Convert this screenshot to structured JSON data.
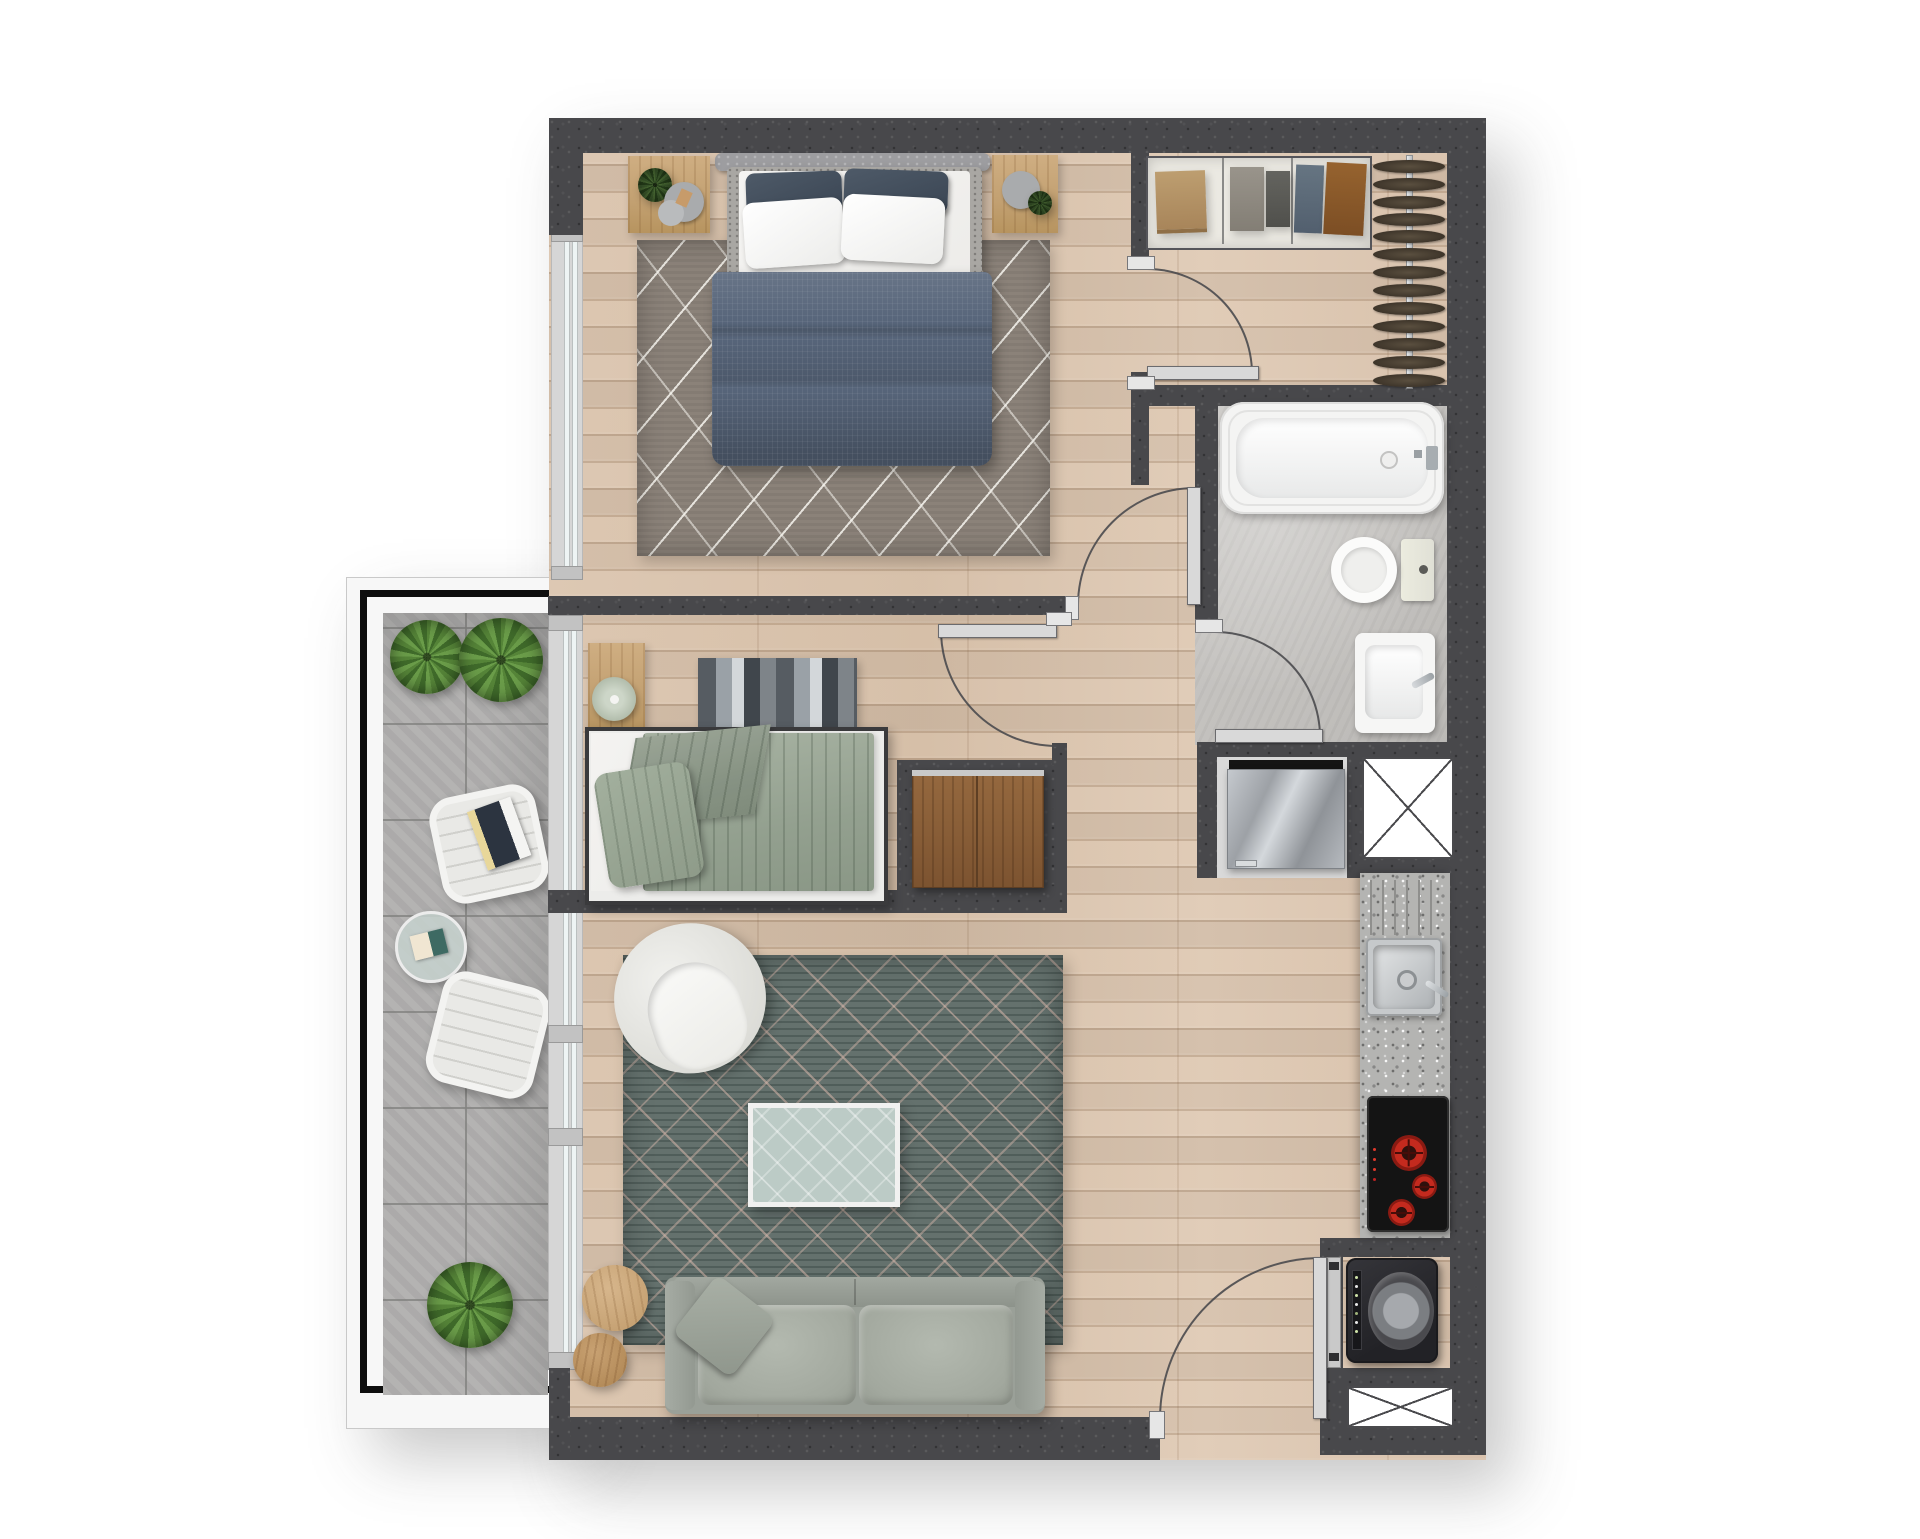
{
  "document": {
    "kind": "apartment floor plan",
    "view": "top-down 3D-rendered plan",
    "visible_text": "none"
  },
  "colors": {
    "wall": "#48484b",
    "wood_floor": "#d9c3ae",
    "bath_floor": "#c5c3c0",
    "balcony_tile": "#b1b0af",
    "balcony_frame": "#f7f7f7",
    "railing_line": "#0e0e0e",
    "master_duvet": "#57657a",
    "master_pillow_dark": "#3e4854",
    "linen_white": "#fafaf9",
    "bedroom_rug": "#8b8279",
    "bedroom2_quilt": "#9fab9c",
    "living_rug": "#64716d",
    "rug_pattern": "#d6b6aa",
    "sofa": "#9aa098",
    "armchair": "#efefec",
    "coffee_table_glass": "#bccbc6",
    "side_table_wood": "#c9a87b",
    "wardrobe_wood": "#8a5e3b",
    "counter_granite": "#b4b4b2",
    "cooktop": "#141414",
    "burner_red": "#c42a1e",
    "fridge_steel": "#b9bdc2",
    "washer_dark": "#2b2b2e",
    "fixture_white": "#f6f6f5",
    "door_leaf": "#d9d9d9",
    "glass_tint": "#eef4f4",
    "shelf_bg": "#ebe9e2",
    "clothes_tan": "#b39365",
    "clothes_gray": "#8f8a81",
    "clothes_charcoal": "#5a5a58",
    "clothes_blue": "#5d6c7b",
    "clothes_brown": "#8a5a2f",
    "hanger_brown": "#4d4436",
    "plant_green": "#55883a"
  },
  "rooms": [
    {
      "id": "master-bedroom",
      "furniture": [
        "double-bed",
        "headboard",
        "dark-pillows",
        "white-pillows",
        "duvet",
        "nightstand-left",
        "nightstand-right",
        "area-rug",
        "window"
      ]
    },
    {
      "id": "walk-in-closet",
      "furniture": [
        "shelf-unit-folded-clothes",
        "hanging-rail",
        "hangers",
        "door-to-bedroom"
      ]
    },
    {
      "id": "bathroom",
      "furniture": [
        "bathtub",
        "toilet",
        "washbasin",
        "door"
      ]
    },
    {
      "id": "bedroom-2",
      "furniture": [
        "single-bed",
        "quilt",
        "pillow",
        "folded-blanket",
        "nightstand",
        "table-lamp",
        "headboard-art",
        "wardrobe-niche",
        "window"
      ]
    },
    {
      "id": "hallway",
      "furniture": [
        "door-master-bedroom",
        "door-bedroom-2",
        "door-bathroom"
      ]
    },
    {
      "id": "living-room",
      "furniture": [
        "sofa",
        "sofa-pillow",
        "armchair",
        "coffee-table",
        "side-table-large",
        "side-table-small",
        "area-rug",
        "sliding-glass-wall"
      ]
    },
    {
      "id": "kitchen",
      "furniture": [
        "granite-counter",
        "sink",
        "faucet",
        "drainboard",
        "cooktop",
        "refrigerator",
        "service-shaft"
      ]
    },
    {
      "id": "laundry-entry",
      "furniture": [
        "washing-machine",
        "service-shaft",
        "entrance-door"
      ]
    },
    {
      "id": "balcony",
      "furniture": [
        "plant",
        "plant",
        "lounge-chair-with-magazines",
        "round-glass-table",
        "lounge-chair",
        "plant",
        "railing-frame"
      ]
    }
  ],
  "counts": {
    "door_swings": 5,
    "closet_hangers": 13,
    "cooktop_burners": 3,
    "shaft_boxes": 2,
    "balcony_plants": 3
  }
}
